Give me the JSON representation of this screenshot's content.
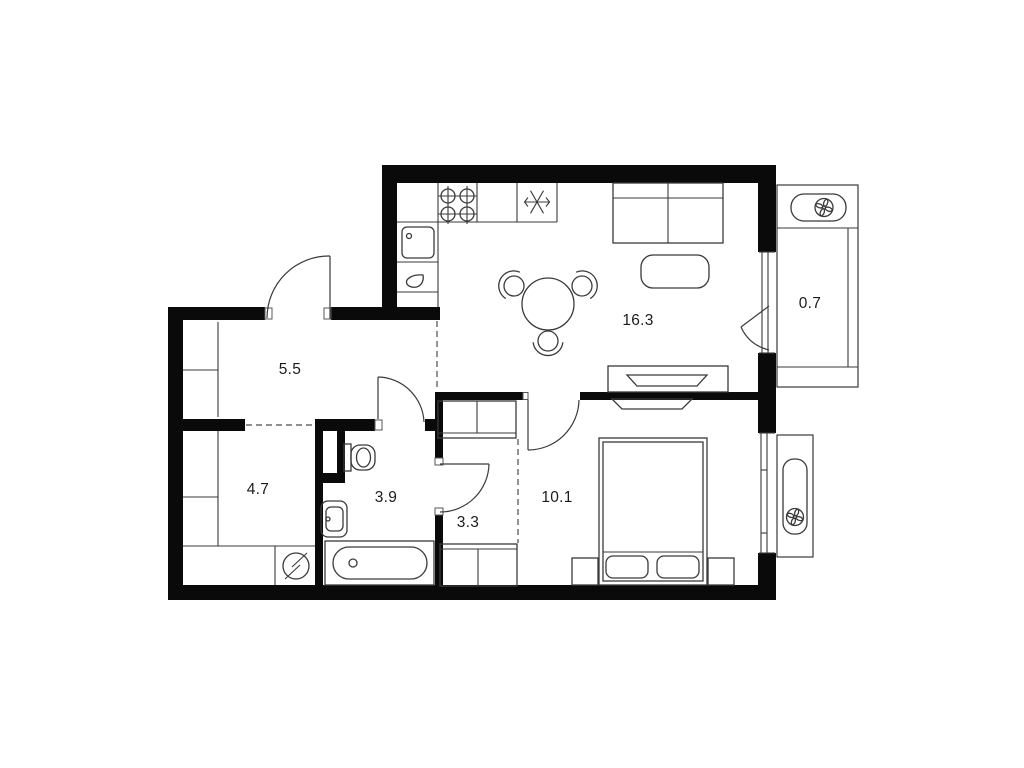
{
  "plan": {
    "type": "apartment-floor-plan",
    "background": "#ffffff",
    "wall_color": "#0a0a0a",
    "furniture_line_color": "#3a3a3a",
    "label_color": "#1c1c1c",
    "rooms": [
      {
        "name": "hallway",
        "area": "5.5"
      },
      {
        "name": "storage-room",
        "area": "4.7"
      },
      {
        "name": "bathroom",
        "area": "3.9"
      },
      {
        "name": "inner-hall",
        "area": "3.3"
      },
      {
        "name": "bedroom",
        "area": "10.1"
      },
      {
        "name": "kitchen-living-room",
        "area": "16.3"
      },
      {
        "name": "balcony",
        "area": "0.7"
      }
    ],
    "icons": {
      "stove": "four-burner-cooktop",
      "fridge": "snowflake",
      "air_conditioner": "fan",
      "washing_machine": "circle-slash",
      "kitchen_sink": "square-basin",
      "bathroom": [
        "toilet",
        "washbasin",
        "bathtub"
      ]
    }
  }
}
